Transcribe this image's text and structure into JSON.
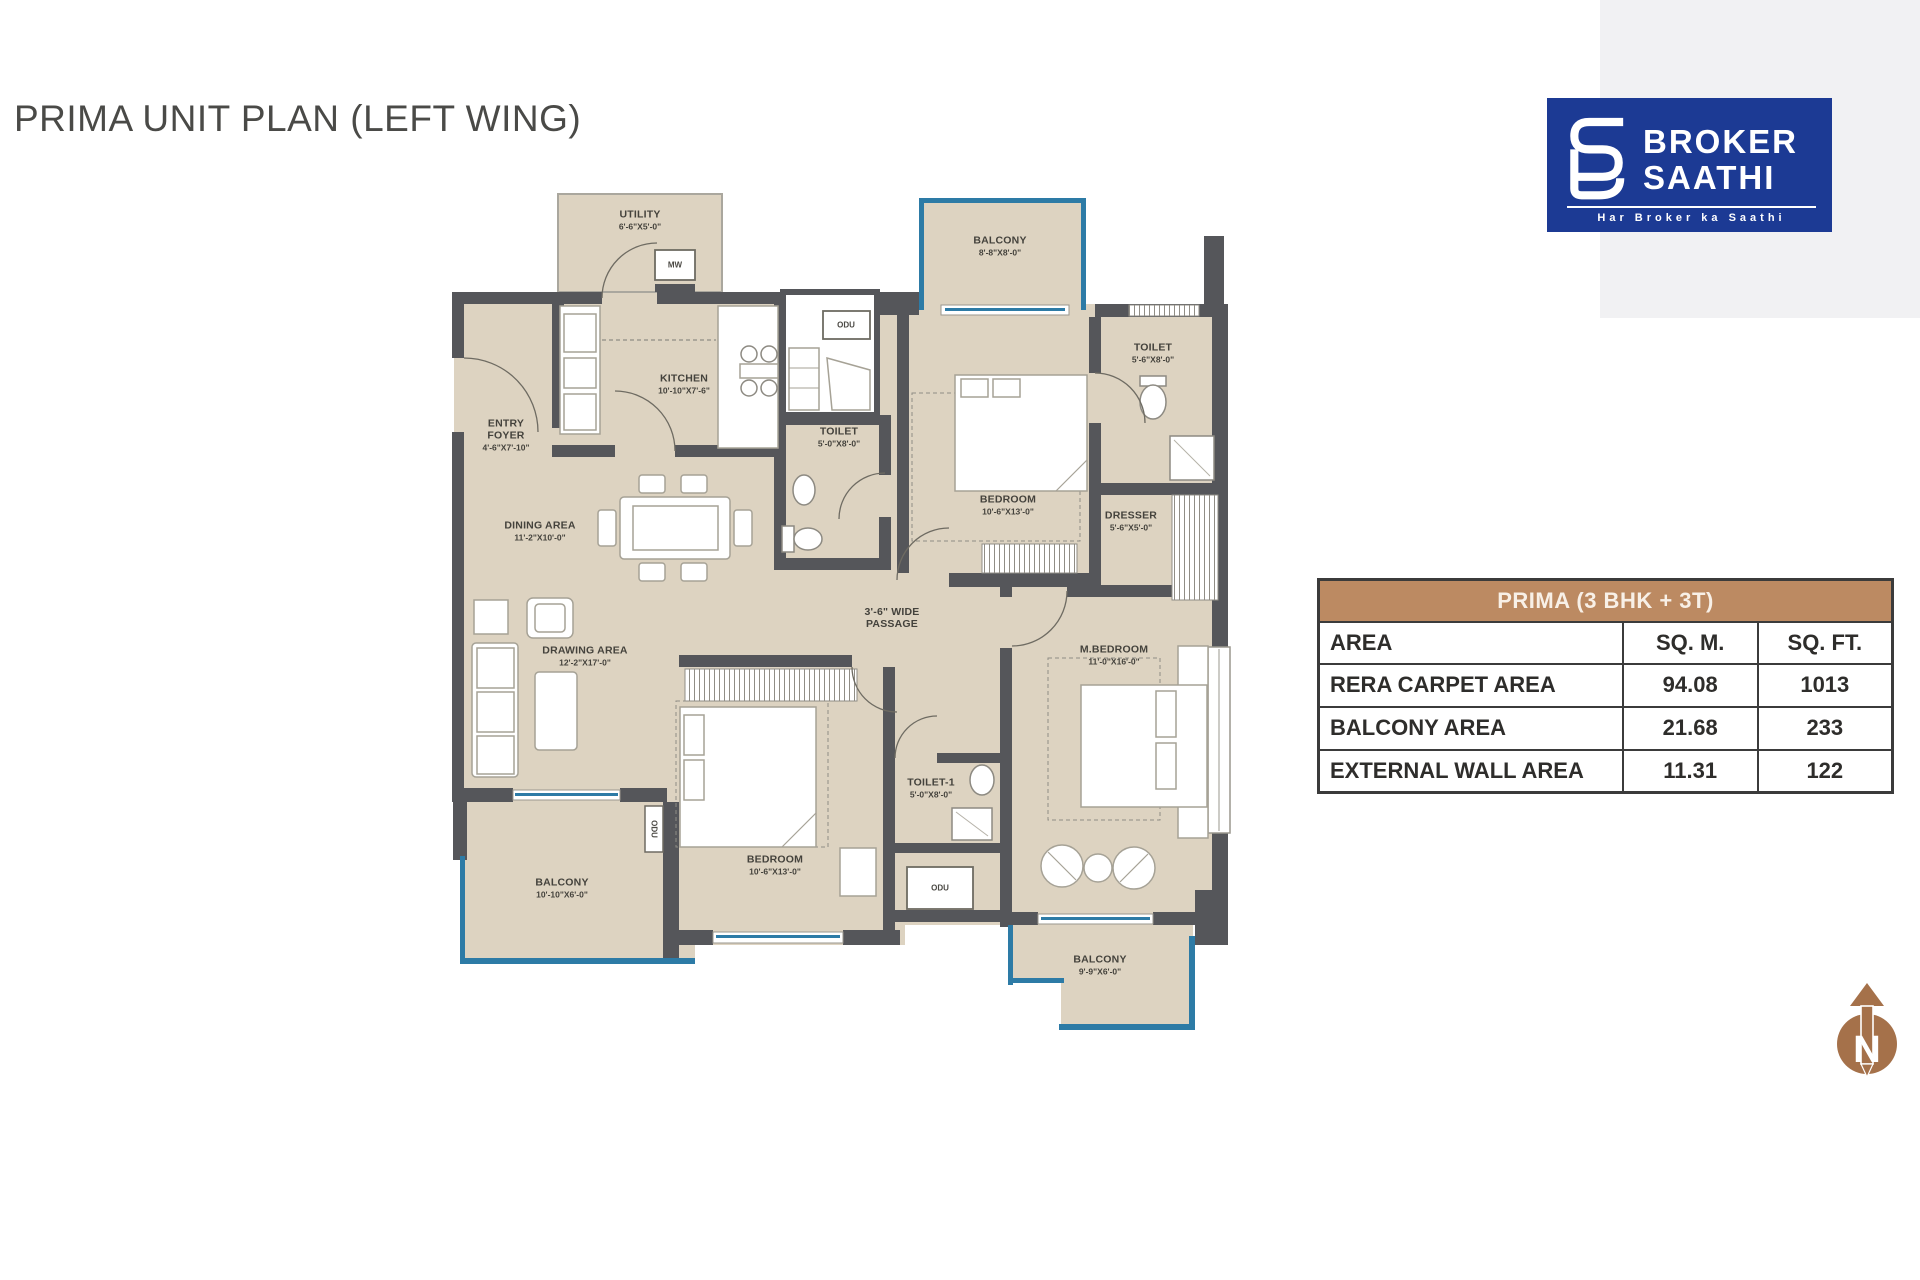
{
  "page": {
    "title": "PRIMA UNIT PLAN (LEFT WING)"
  },
  "logo": {
    "line1": "BROKER",
    "line2": "SAATHI",
    "tagline": "Har Broker ka Saathi"
  },
  "table": {
    "title": "PRIMA (3 BHK + 3T)",
    "columns": [
      "AREA",
      "SQ. M.",
      "SQ. FT."
    ],
    "rows": [
      {
        "label": "RERA CARPET AREA",
        "sqm": "94.08",
        "sqft": "1013"
      },
      {
        "label": "BALCONY AREA",
        "sqm": "21.68",
        "sqft": "233"
      },
      {
        "label": "EXTERNAL WALL AREA",
        "sqm": "11.31",
        "sqft": "122"
      }
    ]
  },
  "compass": {
    "label": "N"
  },
  "colors": {
    "wall": "#55565a",
    "floor": "#ddd3c1",
    "blue": "#2d7ba6",
    "tbl-brown": "#bc8a62",
    "logo-blue": "#1c3a94",
    "bronze": "#a5714a"
  },
  "floor_plan": {
    "rooms": [
      {
        "name": "UTILITY",
        "dims": "6'-6\"X5'-0\"",
        "x": 188,
        "y": 32
      },
      {
        "name": "KITCHEN",
        "dims": "10'-10\"X7'-6\"",
        "x": 232,
        "y": 196
      },
      {
        "name": "ENTRY\nFOYER",
        "dims": "4'-6\"X7'-10\"",
        "x": 54,
        "y": 247
      },
      {
        "name": "DINING AREA",
        "dims": "11'-2\"X10'-0\"",
        "x": 88,
        "y": 343
      },
      {
        "name": "DRAWING AREA",
        "dims": "12'-2\"X17'-0\"",
        "x": 133,
        "y": 468
      },
      {
        "name": "TOILET",
        "dims": "5'-0\"X8'-0\"",
        "x": 387,
        "y": 249
      },
      {
        "name": "BALCONY",
        "dims": "8'-8\"X8'-0\"",
        "x": 548,
        "y": 58
      },
      {
        "name": "TOILET",
        "dims": "5'-6\"X8'-0\"",
        "x": 701,
        "y": 165
      },
      {
        "name": "BEDROOM",
        "dims": "10'-6\"X13'-0\"",
        "x": 556,
        "y": 317
      },
      {
        "name": "DRESSER",
        "dims": "5'-6\"X5'-0\"",
        "x": 679,
        "y": 333
      },
      {
        "name": "3'-6\" WIDE\nPASSAGE",
        "dims": "",
        "x": 440,
        "y": 430
      },
      {
        "name": "M.BEDROOM",
        "dims": "11'-0\"X16'-0\"",
        "x": 662,
        "y": 467
      },
      {
        "name": "BEDROOM",
        "dims": "10'-6\"X13'-0\"",
        "x": 323,
        "y": 677
      },
      {
        "name": "TOILET-1",
        "dims": "5'-0\"X8'-0\"",
        "x": 479,
        "y": 600
      },
      {
        "name": "BALCONY",
        "dims": "10'-10\"X6'-0\"",
        "x": 110,
        "y": 700
      },
      {
        "name": "BALCONY",
        "dims": "9'-9\"X6'-0\"",
        "x": 648,
        "y": 777
      }
    ],
    "fixtures": [
      {
        "text": "MW",
        "x": 223,
        "y": 77
      },
      {
        "text": "ODU",
        "x": 394,
        "y": 137
      },
      {
        "text": "ODU",
        "x": 488,
        "y": 700
      },
      {
        "text": "ODU",
        "x": 202,
        "y": 641,
        "rot": true
      }
    ]
  }
}
